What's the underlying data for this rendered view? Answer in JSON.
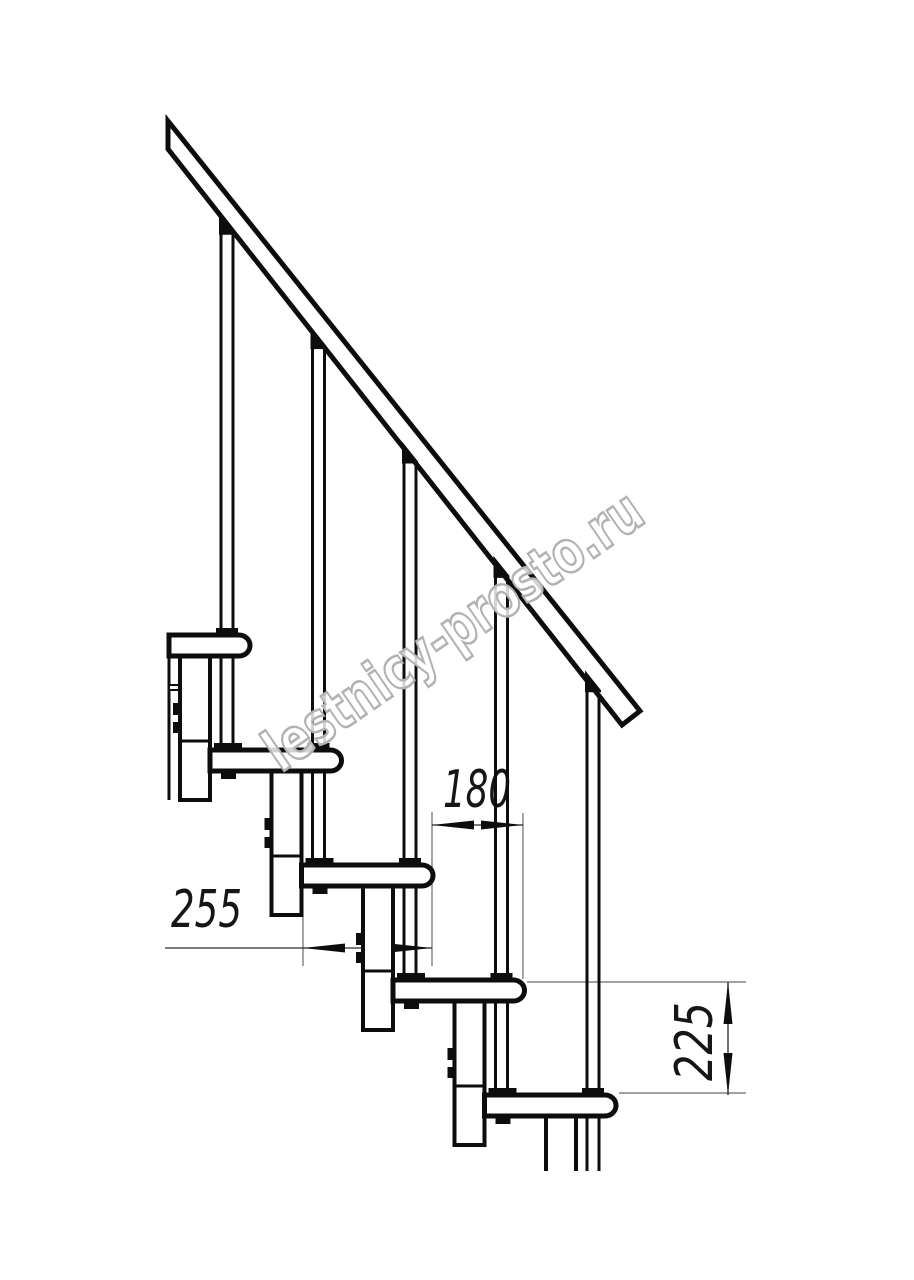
{
  "drawing": {
    "title": "staircase-side-view-technical-drawing",
    "watermark": {
      "text": "lestnicy-prosto.ru"
    },
    "dimensions": {
      "step_run": {
        "value": "180"
      },
      "tread_depth": {
        "value": "255"
      },
      "step_rise": {
        "value": "225"
      }
    }
  }
}
